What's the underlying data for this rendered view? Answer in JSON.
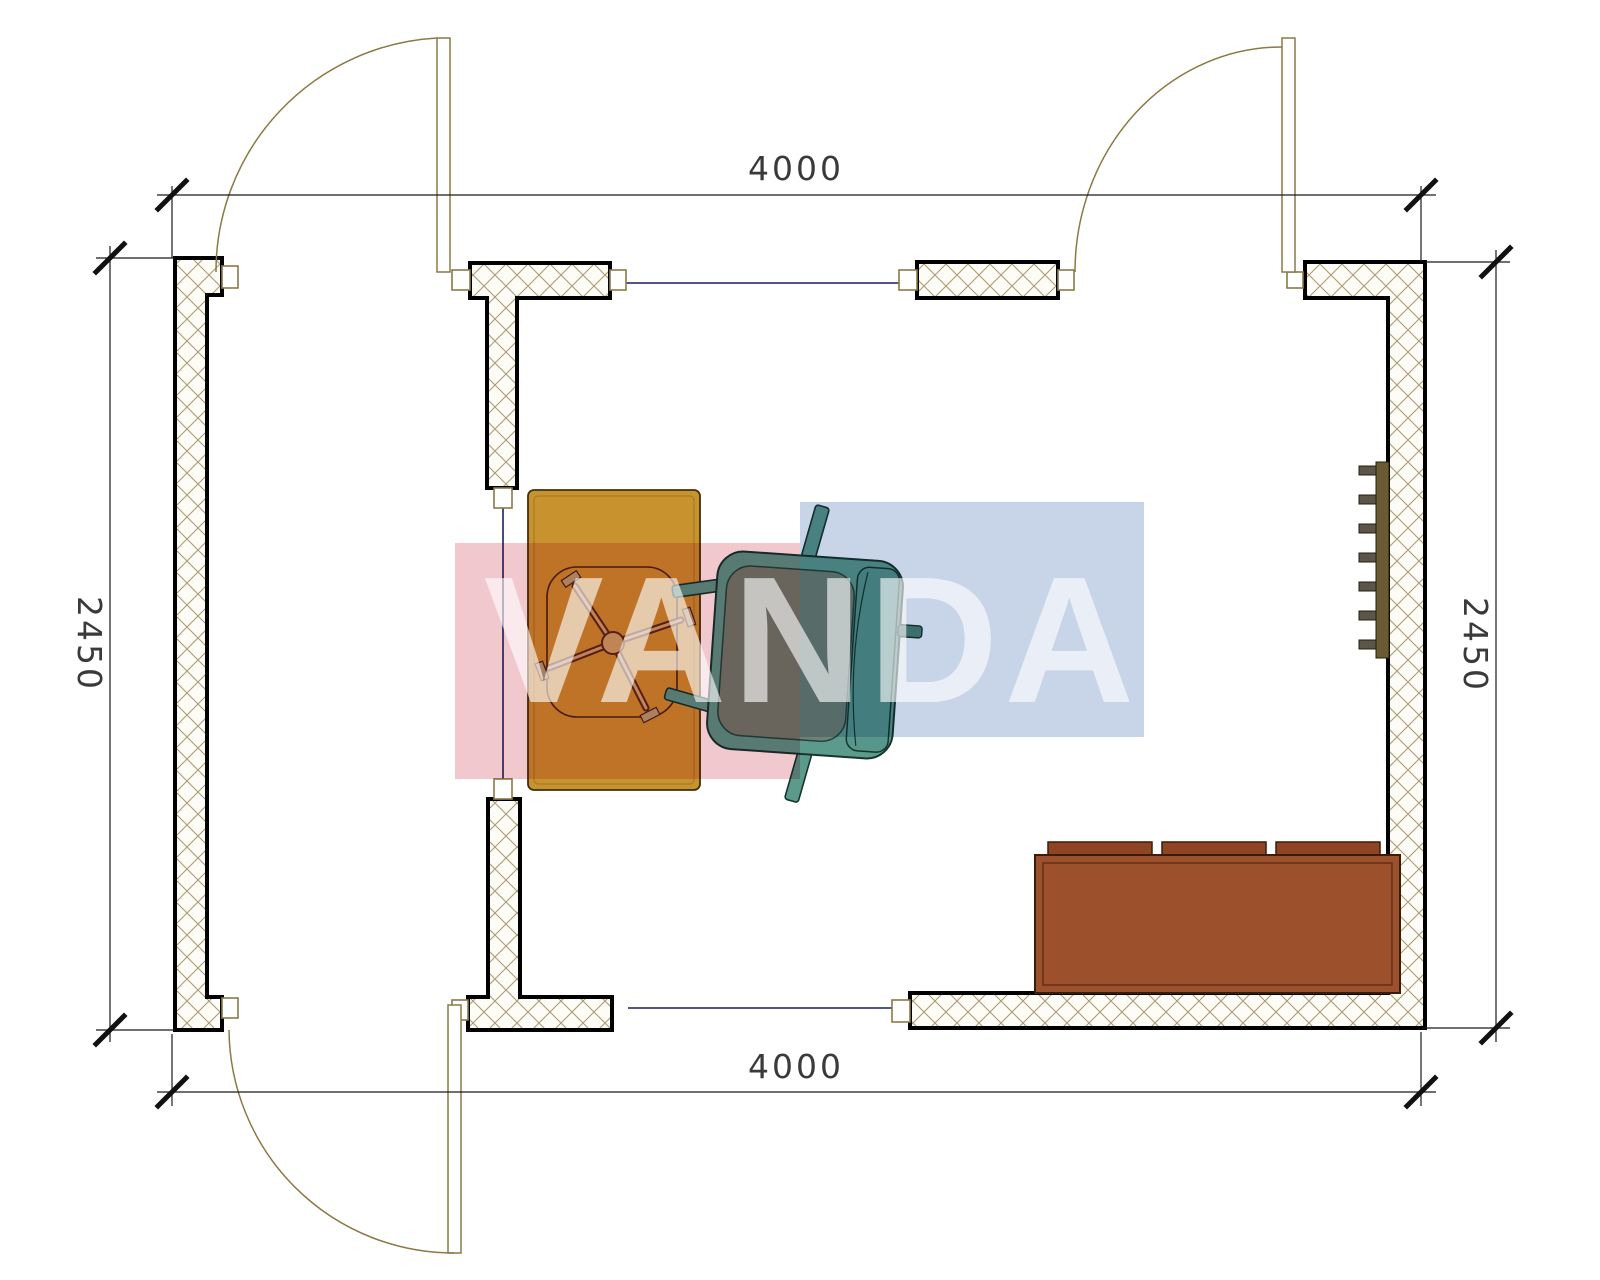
{
  "watermark": {
    "text": "VANDA",
    "pink": "#F2C8CF",
    "blue": "#C8D5E9",
    "text_color": "#FFFFFF"
  },
  "dimensions": {
    "top": "4000",
    "bottom": "4000",
    "left": "2450",
    "right": "2450"
  },
  "colors": {
    "wall_outline": "#000000",
    "wall_fill": "#FDFCF7",
    "wall_hatch": "#AD9B72",
    "window_line": "#1B1F63",
    "door_line": "#8A7A45",
    "dimension_line": "#1a1a1a",
    "desk": "#C8922E",
    "chair_base_fill": "#C9A96B",
    "chair_outline": "#5A2418",
    "armchair": "#5C9B8C",
    "armchair_seat": "#6F8173",
    "armchair_outline": "#173530",
    "sofa": "#9C512C",
    "sofa_cushion": "#8F4424",
    "sofa_outline": "#3A1C08",
    "radiator": "#6B5B35",
    "radiator_fin": "#5C5648"
  }
}
